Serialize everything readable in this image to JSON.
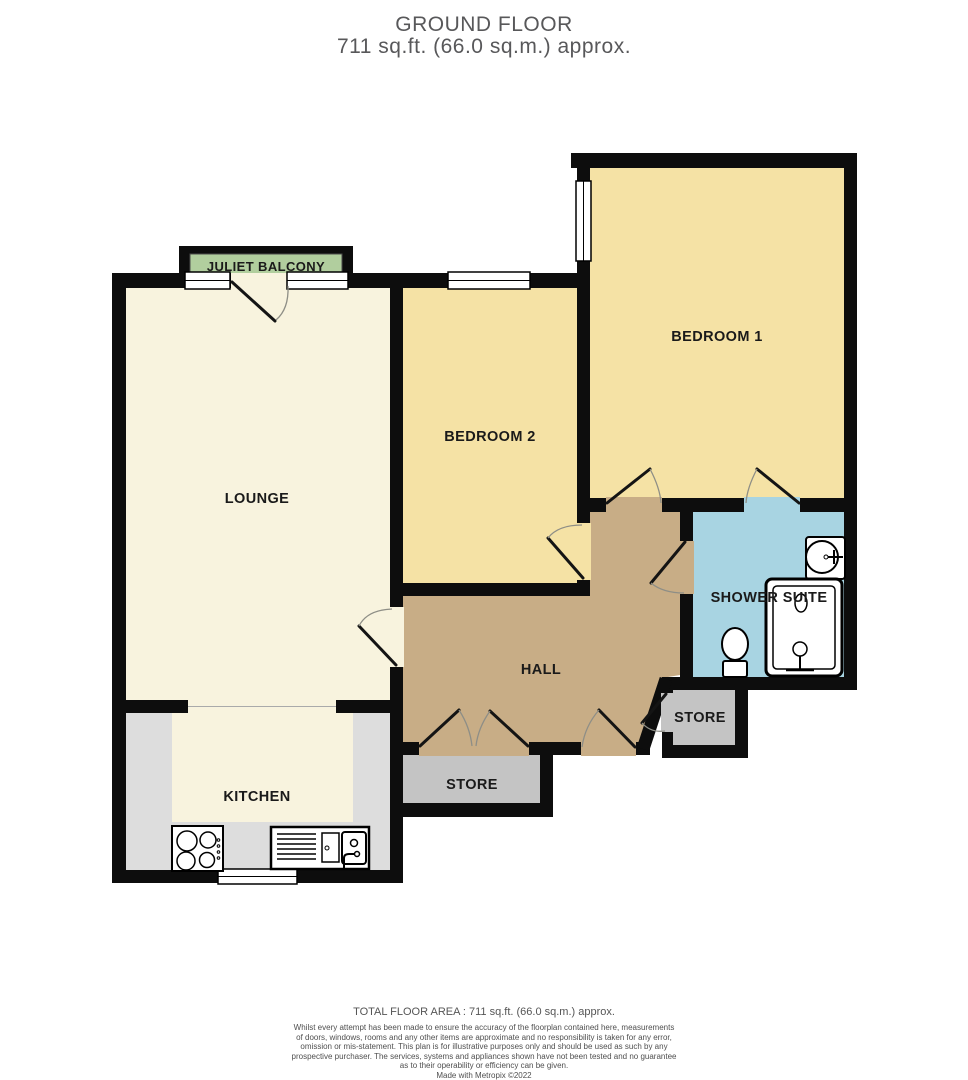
{
  "title": {
    "floor": "GROUND FLOOR",
    "area": "711 sq.ft. (66.0 sq.m.) approx."
  },
  "rooms": {
    "juliet_balcony": "JULIET BALCONY",
    "lounge": "LOUNGE",
    "bedroom2": "BEDROOM 2",
    "bedroom1": "BEDROOM 1",
    "shower_suite": "SHOWER SUITE",
    "hall": "HALL",
    "kitchen": "KITCHEN",
    "store_hall": "STORE",
    "store_inner": "STORE"
  },
  "footer": {
    "total_area": "TOTAL FLOOR AREA : 711 sq.ft. (66.0 sq.m.) approx.",
    "disclaimer": "Whilst every attempt has been made to ensure the accuracy of the floorplan contained here, measurements\nof doors, windows, rooms and any other items are approximate and no responsibility is taken for any error,\nomission or mis-statement. This plan is for illustrative purposes only and should be used as such by any\nprospective purchaser. The services, systems and appliances shown have not been tested and no guarantee\nas to their operability or efficiency can be given.",
    "credit": "Made with Metropix ©2022"
  },
  "colors": {
    "wall": "#0d0d0d",
    "lounge_floor": "#f8f3de",
    "bedroom_floor": "#f5e2a5",
    "hall_floor": "#c8ad86",
    "shower_floor": "#a8d4e2",
    "store_floor": "#c4c4c4",
    "kitchen_counter": "#dddddd",
    "balcony_green": "#b1ce9e",
    "title_text": "#58585a"
  }
}
